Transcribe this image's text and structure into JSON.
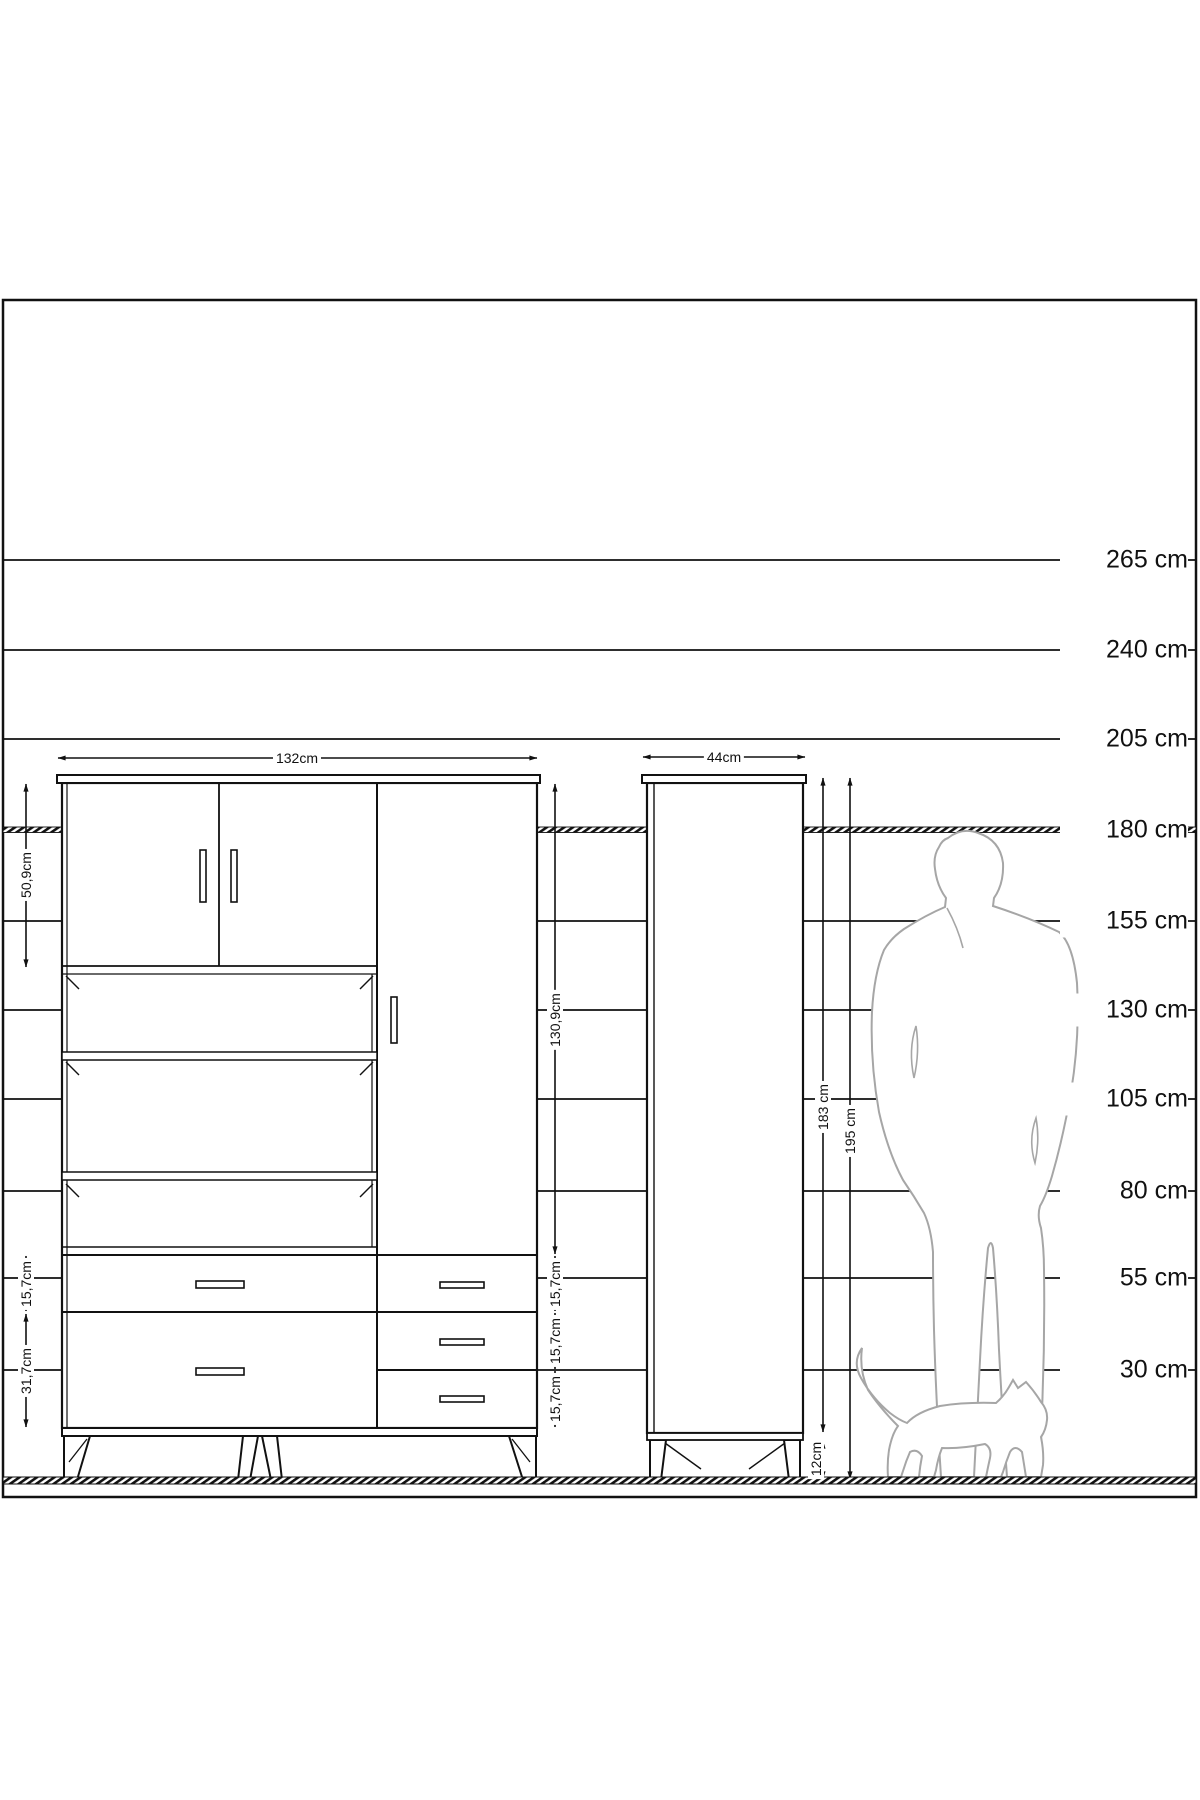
{
  "scale": {
    "unit": "cm",
    "labels": [
      "265 cm",
      "240 cm",
      "205 cm",
      "180 cm",
      "155 cm",
      "130 cm",
      "105 cm",
      "80 cm",
      "55 cm",
      "30 cm"
    ]
  },
  "wardrobe": {
    "width": "132cm",
    "upper_doors_height": "50,9cm",
    "middle_height": "130,9cm",
    "top_drawer_height": "15,7cm",
    "bottom_drawer_height": "31,7cm",
    "side_drawer_heights": [
      "15,7cm",
      "15,7cm",
      "15,7cm"
    ]
  },
  "tall_cabinet": {
    "width": "44cm",
    "body_height": "183 cm",
    "total_height": "195 cm",
    "legs_height": "12cm"
  }
}
